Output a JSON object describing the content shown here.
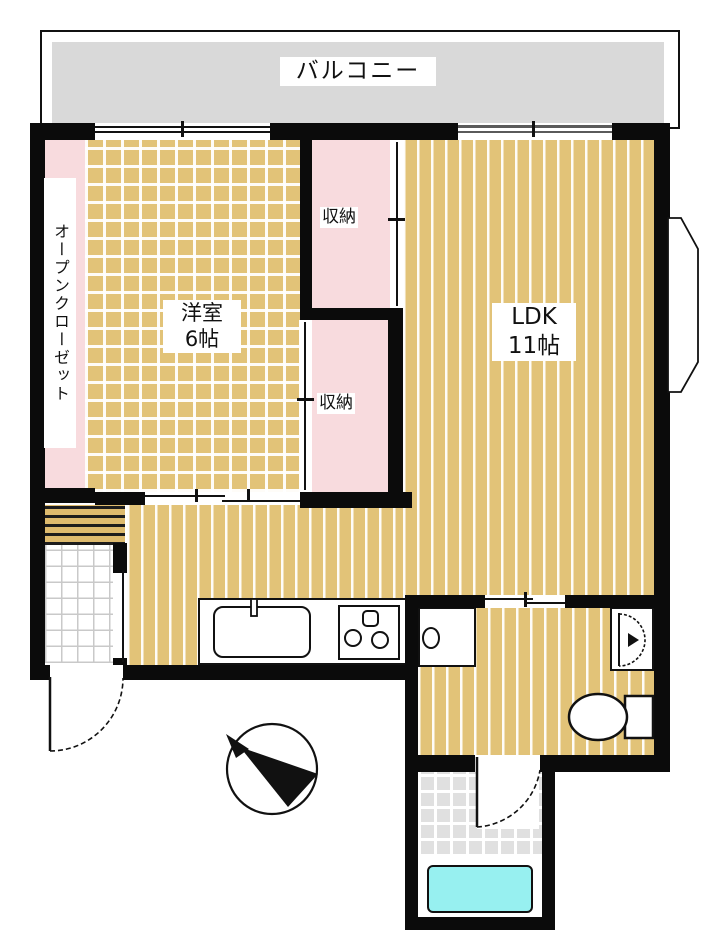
{
  "floorplan": {
    "balcony": "バルコニー",
    "western_room": {
      "name": "洋室",
      "size": "6帖"
    },
    "ldk": {
      "name": "LDK",
      "size": "11帖"
    },
    "storage_upper": "収納",
    "storage_lower": "収納",
    "open_closet": "オープンクローゼット",
    "icons": {
      "compass": "north-compass-needle"
    },
    "fixtures": [
      "kitchen-sink",
      "gas-stove-3-burner",
      "washing-machine-pan",
      "wash-basin",
      "toilet",
      "bathtub",
      "entrance-door",
      "bathroom-door",
      "sliding-doors",
      "windows",
      "bay-duct"
    ],
    "colors": {
      "floor_tan": "#E2C378",
      "closet_pink": "#F8DBDE",
      "balcony_gray": "#D9D9D9",
      "bath_tile_gray": "#E0E0E0",
      "bathtub_cyan": "#97F0F0",
      "wall_black": "#0B0B0B"
    }
  }
}
